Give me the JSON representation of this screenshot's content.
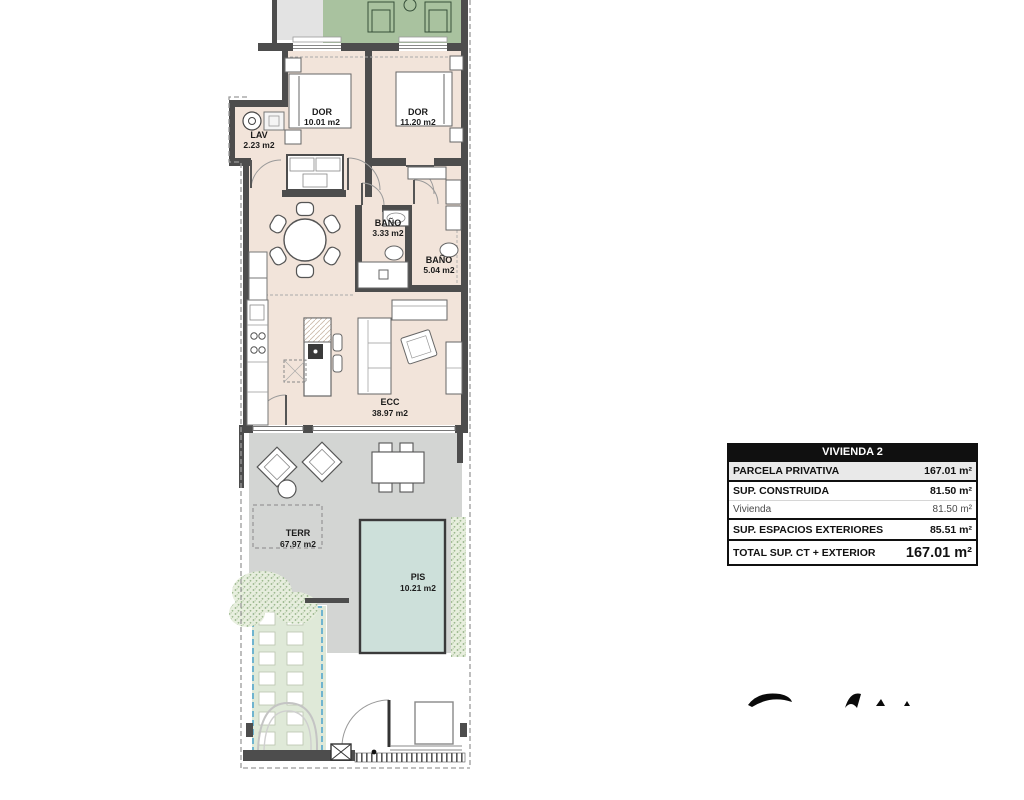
{
  "document": {
    "type": "apartment-floor-plan"
  },
  "plan": {
    "rooms": [
      {
        "name": "DOR",
        "area": "10.01 m2"
      },
      {
        "name": "DOR",
        "area": "11.20 m2"
      },
      {
        "name": "LAV",
        "area": "2.23 m2"
      },
      {
        "name": "BAÑO",
        "area": "3.33 m2"
      },
      {
        "name": "BAÑO",
        "area": "5.04 m2"
      },
      {
        "name": "ECC",
        "area": "38.97 m2"
      },
      {
        "name": "TERR",
        "area": "67.97 m2"
      },
      {
        "name": "PIS",
        "area": "10.21 m2"
      }
    ],
    "colors": {
      "interior_floor": "#f2e4da",
      "roof_terrace_green": "#a9c29f",
      "terrace_gray": "#d3d5d3",
      "pool": "#cde0da",
      "walls": "#4d4d4d",
      "paver_green": "#dfe9d8",
      "pool_area_dashed_outline": "#4aa3cc"
    }
  },
  "summary_table": {
    "title": "VIVIENDA 2",
    "rows": [
      {
        "label": "PARCELA PRIVATIVA",
        "value": "167.01 m²"
      },
      {
        "label": "SUP. CONSTRUIDA",
        "value": "81.50 m²"
      },
      {
        "label": "Vivienda",
        "value": "81.50 m²"
      },
      {
        "label": "SUP. ESPACIOS EXTERIORES",
        "value": "85.51 m²"
      },
      {
        "label": "TOTAL SUP. CT + EXTERIOR",
        "value": "167.01 m²"
      }
    ]
  },
  "branding": {
    "logo_fragments": "cropped illegible logo letter tops"
  }
}
